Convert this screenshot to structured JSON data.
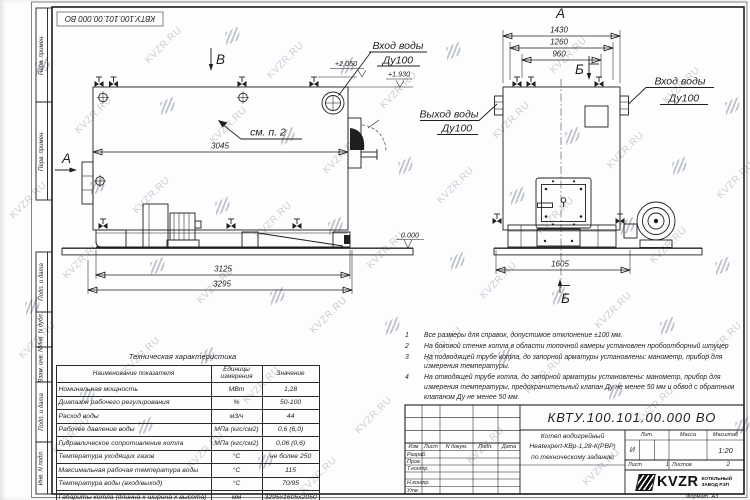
{
  "stamp_top": "КВТУ.100.101.00.000 ВО",
  "watermark": {
    "text": "KVZR.RU"
  },
  "side_strip": {
    "labels": [
      "Перв. примен.",
      "Перв. примен.",
      "Подп. и дата",
      "Инв. N дубл.",
      "Взам. инв. N",
      "Подп. и дата",
      "Инв. N подл."
    ]
  },
  "labels": {
    "view_b": "В",
    "view_a": "А",
    "section_a": "А",
    "section_b_top": "Б",
    "section_b_bottom": "Б",
    "see_note": "см. п. 2",
    "inlet1": "Вход воды",
    "inlet2": "Ду100",
    "outlet1": "Выход воды",
    "outlet2": "Ду100"
  },
  "dims": {
    "d3045": "3045",
    "d3125": "3125",
    "d3295": "3295",
    "d1430": "1430",
    "d1260": "1260",
    "d960": "960",
    "d1605": "1605"
  },
  "elevations": {
    "high": "+2.050",
    "mid": "+1.930",
    "zero": "0.000"
  },
  "table": {
    "title": "Техническая характеристика",
    "headers": [
      "Наименование показателя",
      "Единицы измерения",
      "Значение"
    ],
    "rows": [
      {
        "name": "Номинальная мощность",
        "unit": "МВт",
        "value": "1,28"
      },
      {
        "name": "Диапазон рабочего регулирования",
        "unit": "%",
        "value": "50-100"
      },
      {
        "name": "Расход воды",
        "unit": "м3/ч",
        "value": "44"
      },
      {
        "name": "Рабочее давление воды",
        "unit": "МПа (кгс/см2)",
        "value": "0,6 (6,0)"
      },
      {
        "name": "Гидравлическое сопротивление котла",
        "unit": "МПа (кгс/см2)",
        "value": "0,06 (0,6)"
      },
      {
        "name": "Температура уходящих газов",
        "unit": "°С",
        "value": "не более 250"
      },
      {
        "name": "Максимальная рабочая температура воды",
        "unit": "°С",
        "value": "115"
      },
      {
        "name": "Температура воды (вход/выход)",
        "unit": "°С",
        "value": "70/95"
      },
      {
        "name": "Габариты котла (длинна х ширина х высота)",
        "unit": "мм",
        "value": "3295х1605х2050"
      }
    ]
  },
  "notes": {
    "items": [
      {
        "num": "1",
        "text": "Все размеры для справок, допустимое отклонение ±100 мм."
      },
      {
        "num": "2",
        "text": "На боковой стенке котла в области топочной камеры установлен пробоотборный штуцер"
      },
      {
        "num": "3",
        "text": "На подводящей трубе котла, до запорной арматуры установлены: манометр, прибор для измерения температуры."
      },
      {
        "num": "4",
        "text": "На отводящей трубе котла, до запорной арматуры установлены: манометр, прибор для измерения температуры, предохранительный клапан Ду не менее 50 мм и обвод с обратным клапаном Ду не менее 50 мм."
      }
    ]
  },
  "title_block": {
    "doc_number": "КВТУ.100.101.00.000 ВО",
    "header_cols": [
      "Изм",
      "Лист",
      "N докум.",
      "Подп.",
      "Дата"
    ],
    "row_labels": [
      "Разраб.",
      "Пров.",
      "Т.контр.",
      "Н.контр.",
      "Утв."
    ],
    "name_line1": "Котел водогрейный",
    "name_line2": "Heatexpert-КВр-1,28-К(РВР)",
    "name_line3": "по техническому заданию",
    "lit_header": "Лит.",
    "mass_header": "Масса",
    "scale_header": "Масштаб",
    "lit_value": "И",
    "scale_value": "1:20",
    "sheet_label": "Лист",
    "sheet_value": "1",
    "sheets_label": "Листов",
    "sheets_value": "2",
    "logo_text": "KVZR",
    "company_line1": "КОТЕЛЬНЫЙ",
    "company_line2": "ЗАВОД РЭП",
    "format_label": "Формат  А3"
  }
}
